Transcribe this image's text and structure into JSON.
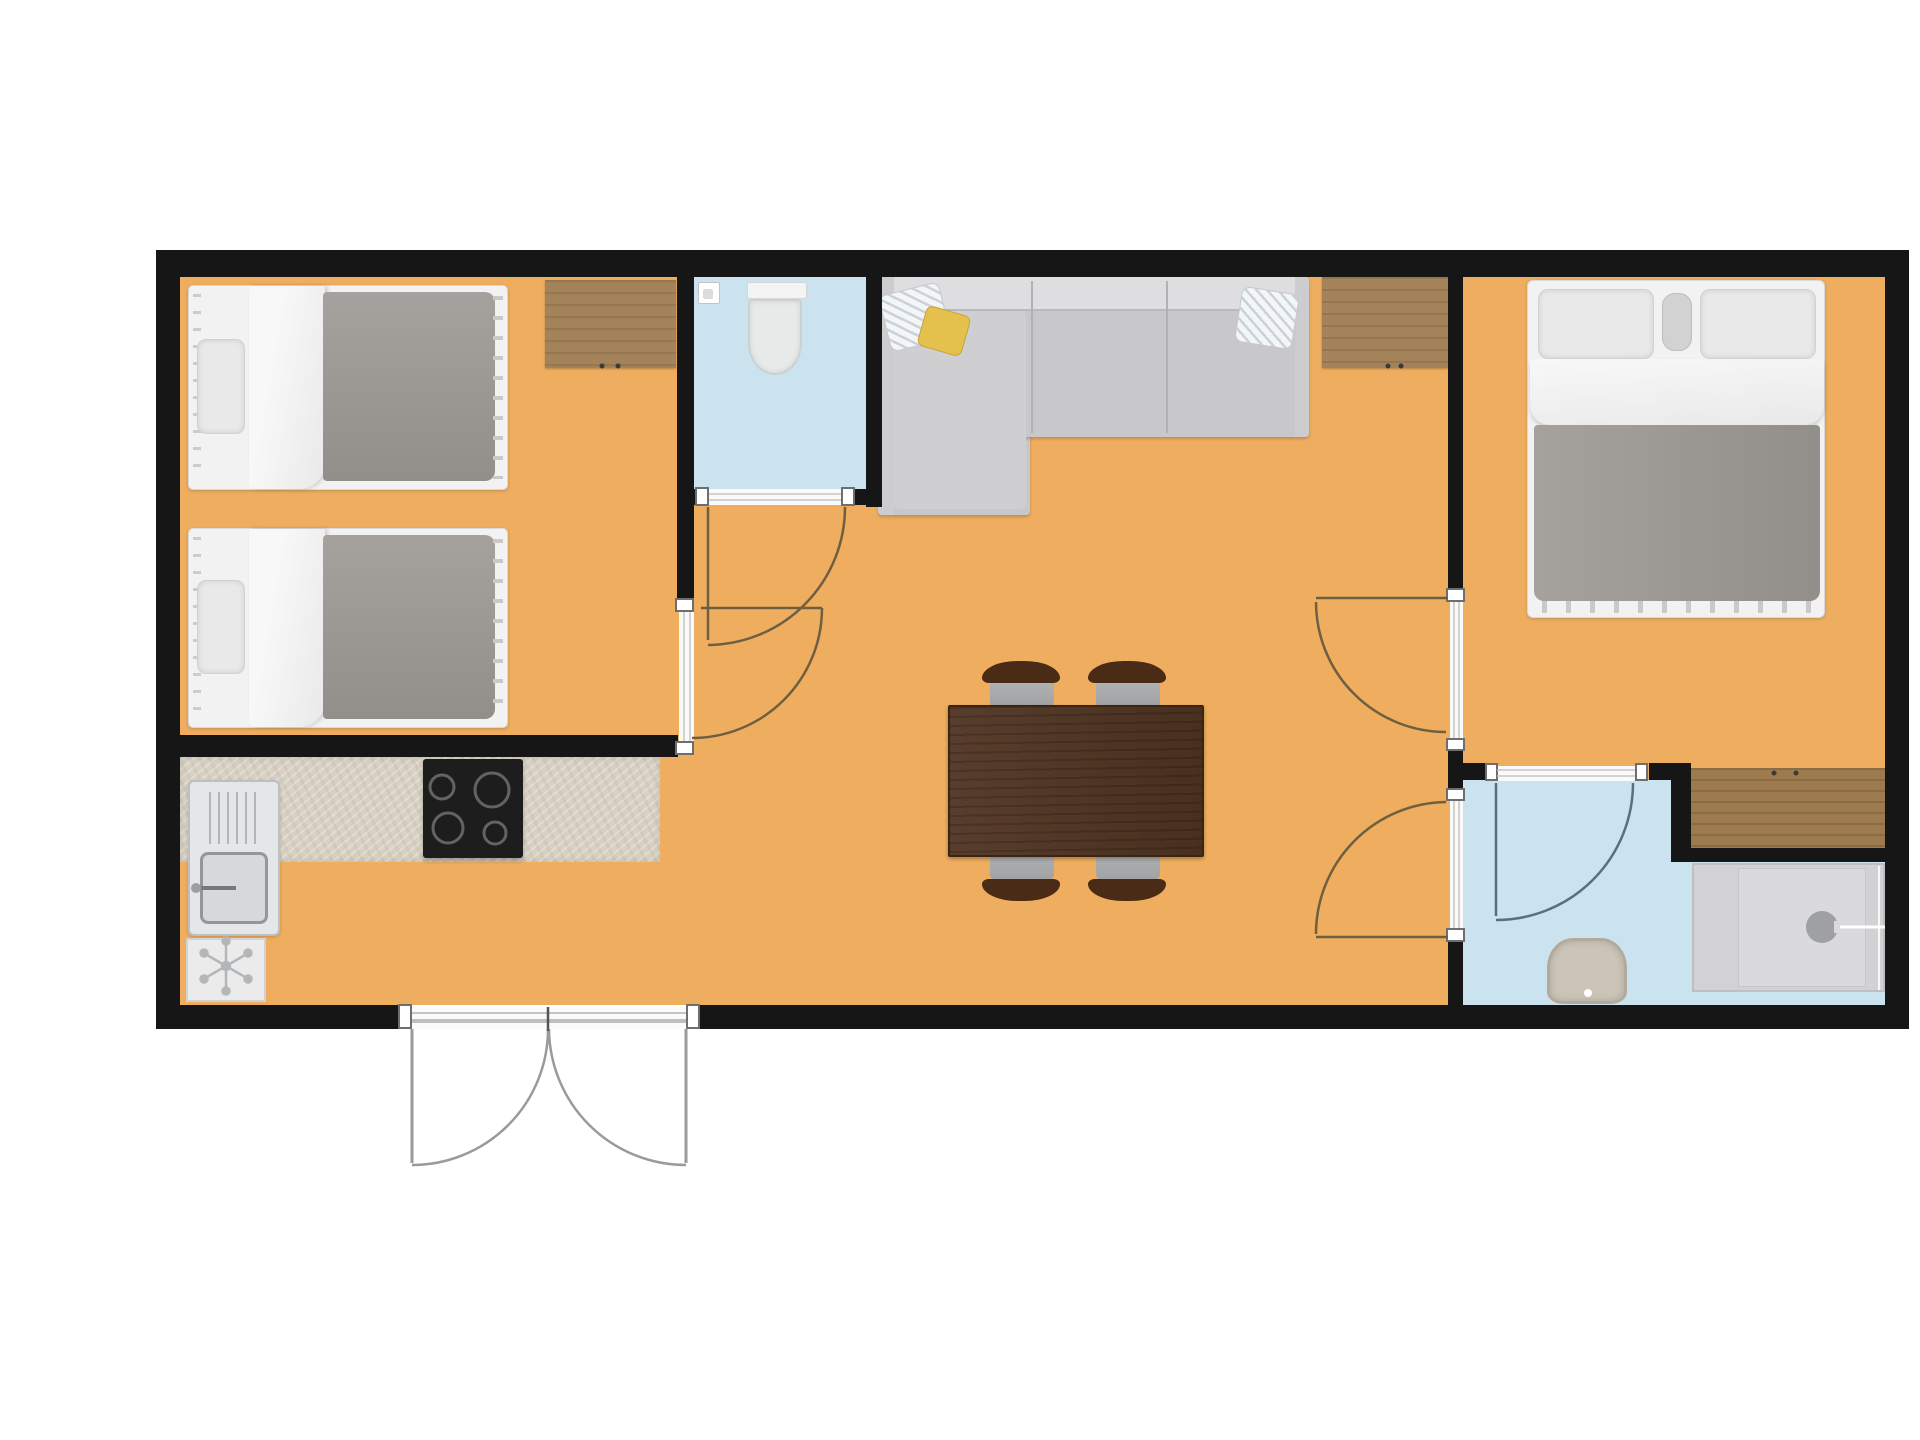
{
  "title": "apartment-floor-plan",
  "description": "Top-down architectural floor plan of a two-bedroom holiday apartment; no text labels are rendered in the image",
  "colors": {
    "bg": "#ffffff",
    "wall": "#161616",
    "floor": "#efae5f",
    "wet_floor": "#cbe3ee",
    "wood": "#a5835a",
    "wood_dark": "#9d7b4f",
    "counter": "#d8d1c3",
    "table": "#4f3321",
    "chair_back": "#4a2b15",
    "chair_seat": "#9fa1a3",
    "sofa": "#c8c8cb",
    "sofa_back": "#dedee1",
    "sofa_arm": "#cdcdd0",
    "sofa_pad": "#cfcfd2",
    "duvet": "#9b9793",
    "linen": "#f2f2f2",
    "pillow": "#e9e9e9",
    "pillow_yellow": "#e4c04c",
    "stove": "#1d1d1d",
    "steel": "#e4e6e7",
    "appliance": "#ebebeb",
    "shower_tray": "#d2d2d4",
    "shower_inner": "#dadadc",
    "bath_sink": "#cbc5b8",
    "toilet": "#e7eae9",
    "swing_arc": "#6e5f41",
    "swing_arc_wet": "#57707e",
    "entry_stroke": "#9a9a9a",
    "band": "#c4c4c4",
    "jamb_border": "#6e6e6e"
  },
  "rooms": [
    {
      "name": "bedroom-twin",
      "floor": "orange-laminate",
      "furniture": [
        "single-bed",
        "single-bed",
        "desk-cabinet"
      ]
    },
    {
      "name": "wc",
      "floor": "blue-tile",
      "furniture": [
        "toilet",
        "toilet-paper-holder"
      ]
    },
    {
      "name": "living-dining",
      "floor": "orange-laminate",
      "furniture": [
        "corner-sofa",
        "sofa-cushions",
        "sideboard",
        "dining-table",
        "chair-x4"
      ]
    },
    {
      "name": "kitchen",
      "floor": "orange-laminate",
      "furniture": [
        "counter",
        "kitchen-sink",
        "cooktop-4-burners",
        "refrigerator"
      ]
    },
    {
      "name": "bedroom-double",
      "floor": "orange-laminate",
      "furniture": [
        "double-bed",
        "wardrobe"
      ]
    },
    {
      "name": "bathroom",
      "floor": "blue-tile",
      "furniture": [
        "washbasin",
        "shower"
      ]
    }
  ],
  "doors": [
    {
      "name": "entrance-double-door",
      "type": "double-swing-outward",
      "wall": "bottom"
    },
    {
      "name": "bedroom-twin-door",
      "type": "single-swing"
    },
    {
      "name": "wc-door",
      "type": "single-swing"
    },
    {
      "name": "bedroom-double-door",
      "type": "single-swing"
    },
    {
      "name": "bathroom-hall-door",
      "type": "single-swing"
    },
    {
      "name": "bathroom-inner-door",
      "type": "single-swing"
    }
  ]
}
